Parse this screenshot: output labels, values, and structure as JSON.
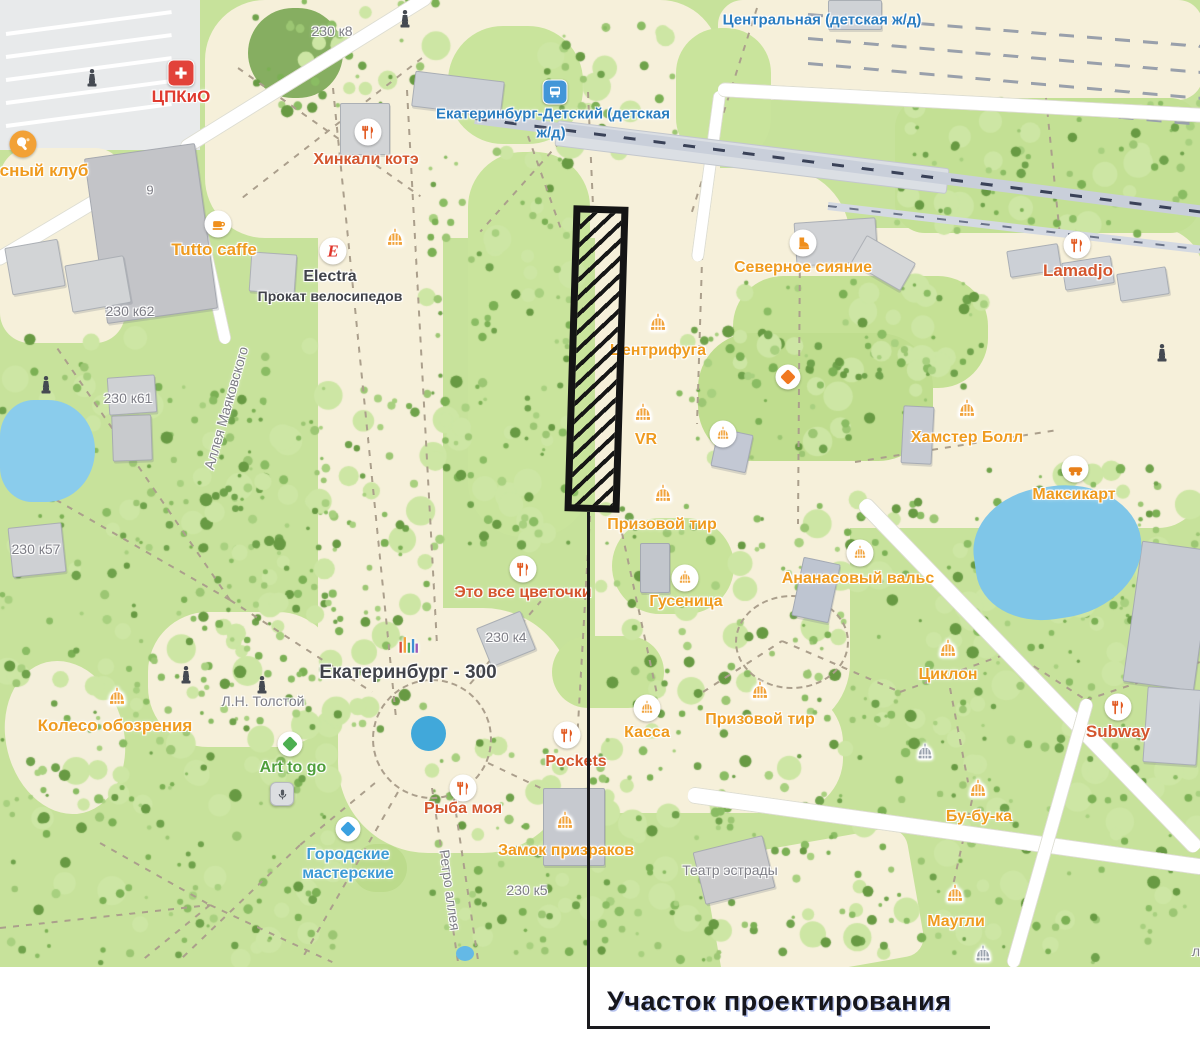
{
  "callout": {
    "label": "Участок проектирования"
  },
  "palette": {
    "poi_orange": "#ef9b1f",
    "poi_terracotta": "#d4562e",
    "transit_blue": "#2b7dc0",
    "poi_blue": "#3e9bd5",
    "poi_green": "#4f9f3c",
    "street_gray": "#7d7d85",
    "title_dark": "#41434a",
    "brand_red": "#e03a2f",
    "site_outline": "#141414",
    "water": "#7fc6e8"
  },
  "map": {
    "labels": [
      {
        "t": "ЦПКиО",
        "x": 181,
        "y": 97,
        "c": "red",
        "s": 17,
        "i": true
      },
      {
        "t": "сный клуб",
        "x": 44,
        "y": 171,
        "c": "orange",
        "s": 17,
        "i": true
      },
      {
        "t": "230 к8",
        "x": 332,
        "y": 31,
        "c": "gray",
        "s": 14,
        "w": "normal"
      },
      {
        "t": "Хинкали котэ",
        "x": 366,
        "y": 160,
        "c": "terra",
        "s": 16,
        "i": true
      },
      {
        "t": "Екатеринбург-Детский (детская",
        "x": 553,
        "y": 114,
        "c": "blue",
        "s": 15,
        "i": true
      },
      {
        "t": "ж/д)",
        "x": 551,
        "y": 133,
        "c": "blue",
        "s": 15,
        "i": true
      },
      {
        "t": "Центральная (детская ж/д)",
        "x": 822,
        "y": 20,
        "c": "blue",
        "s": 15,
        "i": true
      },
      {
        "t": "Tutto caffe",
        "x": 214,
        "y": 250,
        "c": "orange",
        "s": 17,
        "i": true
      },
      {
        "t": "Electra",
        "x": 330,
        "y": 277,
        "c": "dark",
        "s": 16,
        "i": true
      },
      {
        "t": "Прокат велосипедов",
        "x": 330,
        "y": 296,
        "c": "dark",
        "s": 14,
        "i": true
      },
      {
        "t": "230 к62",
        "x": 130,
        "y": 311,
        "c": "gray",
        "s": 14,
        "w": "normal"
      },
      {
        "t": "Аллея Маяковского",
        "x": 226,
        "y": 408,
        "c": "gray",
        "s": 14,
        "w": "normal",
        "r": -74
      },
      {
        "t": "230 к61",
        "x": 128,
        "y": 398,
        "c": "gray",
        "s": 14,
        "w": "normal"
      },
      {
        "t": "230 к57",
        "x": 36,
        "y": 549,
        "c": "gray",
        "s": 14,
        "w": "normal"
      },
      {
        "t": "Северное сияние",
        "x": 803,
        "y": 268,
        "c": "orange",
        "s": 16,
        "i": true
      },
      {
        "t": "Lamadjo",
        "x": 1078,
        "y": 271,
        "c": "terra",
        "s": 17,
        "i": true
      },
      {
        "t": "Центрифуга",
        "x": 658,
        "y": 351,
        "c": "orange",
        "s": 16,
        "i": true
      },
      {
        "t": "VR",
        "x": 646,
        "y": 440,
        "c": "orange",
        "s": 16,
        "i": true
      },
      {
        "t": "Хамстер Болл",
        "x": 967,
        "y": 438,
        "c": "orange",
        "s": 16,
        "i": true
      },
      {
        "t": "Максикарт",
        "x": 1074,
        "y": 495,
        "c": "orange",
        "s": 16,
        "i": true
      },
      {
        "t": "Призовой тир",
        "x": 662,
        "y": 525,
        "c": "orange",
        "s": 16,
        "i": true
      },
      {
        "t": "Ананасовый вальс",
        "x": 858,
        "y": 579,
        "c": "orange",
        "s": 16,
        "i": true
      },
      {
        "t": "Это все цветочки",
        "x": 523,
        "y": 593,
        "c": "terra",
        "s": 16,
        "i": true
      },
      {
        "t": "Гусеница",
        "x": 686,
        "y": 602,
        "c": "orange",
        "s": 16,
        "i": true
      },
      {
        "t": "230 к4",
        "x": 506,
        "y": 637,
        "c": "gray",
        "s": 14,
        "w": "normal"
      },
      {
        "t": "Екатеринбург - 300",
        "x": 408,
        "y": 673,
        "c": "dark",
        "s": 19,
        "i": true
      },
      {
        "t": "Л.Н. Толстой",
        "x": 263,
        "y": 701,
        "c": "gray",
        "s": 14,
        "w": "normal"
      },
      {
        "t": "Колесо обозрения",
        "x": 115,
        "y": 726,
        "c": "orange",
        "s": 17,
        "i": true
      },
      {
        "t": "Art to go",
        "x": 293,
        "y": 768,
        "c": "green",
        "s": 16,
        "i": true
      },
      {
        "t": "Касса",
        "x": 647,
        "y": 733,
        "c": "orange",
        "s": 16,
        "i": true
      },
      {
        "t": "Призовой тир",
        "x": 760,
        "y": 720,
        "c": "orange",
        "s": 16,
        "i": true
      },
      {
        "t": "Циклон",
        "x": 948,
        "y": 675,
        "c": "orange",
        "s": 16,
        "i": true
      },
      {
        "t": "Subway",
        "x": 1118,
        "y": 732,
        "c": "terra",
        "s": 17,
        "i": true
      },
      {
        "t": "Pockets",
        "x": 576,
        "y": 762,
        "c": "terra",
        "s": 16,
        "i": true
      },
      {
        "t": "Рыба моя",
        "x": 463,
        "y": 809,
        "c": "terra",
        "s": 16,
        "i": true
      },
      {
        "t": "Городские",
        "x": 348,
        "y": 855,
        "c": "bluepoi",
        "s": 16,
        "i": true
      },
      {
        "t": "мастерские",
        "x": 348,
        "y": 874,
        "c": "bluepoi",
        "s": 16,
        "i": true
      },
      {
        "t": "Замок призраков",
        "x": 566,
        "y": 851,
        "c": "orange",
        "s": 16,
        "i": true
      },
      {
        "t": "230 к5",
        "x": 527,
        "y": 890,
        "c": "gray",
        "s": 14,
        "w": "normal"
      },
      {
        "t": "Ретро аллея",
        "x": 450,
        "y": 890,
        "c": "gray",
        "s": 14,
        "w": "normal",
        "r": 82
      },
      {
        "t": "Театр эстрады",
        "x": 730,
        "y": 870,
        "c": "gray",
        "s": 14,
        "w": "normal"
      },
      {
        "t": "Бу-бу-ка",
        "x": 979,
        "y": 817,
        "c": "orange",
        "s": 16,
        "i": true
      },
      {
        "t": "Маугли",
        "x": 956,
        "y": 922,
        "c": "orange",
        "s": 16,
        "i": true
      },
      {
        "t": "9",
        "x": 150,
        "y": 190,
        "c": "gray",
        "s": 13,
        "w": "normal"
      },
      {
        "t": "л",
        "x": 1196,
        "y": 951,
        "c": "gray",
        "s": 14,
        "w": "normal"
      }
    ],
    "icons": [
      {
        "k": "cpkio",
        "x": 181,
        "y": 73
      },
      {
        "k": "pingpong",
        "x": 23,
        "y": 144
      },
      {
        "k": "fork",
        "x": 368,
        "y": 132
      },
      {
        "k": "transit",
        "x": 555,
        "y": 92
      },
      {
        "k": "statue",
        "x": 405,
        "y": 18
      },
      {
        "k": "statue",
        "x": 92,
        "y": 77
      },
      {
        "k": "coffee",
        "x": 218,
        "y": 224
      },
      {
        "k": "electra",
        "x": 333,
        "y": 251
      },
      {
        "k": "carousel",
        "x": 395,
        "y": 241
      },
      {
        "k": "statue",
        "x": 46,
        "y": 384
      },
      {
        "k": "carousel",
        "x": 658,
        "y": 326
      },
      {
        "k": "carousel",
        "x": 643,
        "y": 416
      },
      {
        "k": "carousel-circle",
        "x": 723,
        "y": 434
      },
      {
        "k": "diamond-orange",
        "x": 788,
        "y": 377
      },
      {
        "k": "boot",
        "x": 803,
        "y": 243
      },
      {
        "k": "fork",
        "x": 1077,
        "y": 245
      },
      {
        "k": "carousel",
        "x": 967,
        "y": 412
      },
      {
        "k": "kart",
        "x": 1075,
        "y": 469
      },
      {
        "k": "carousel",
        "x": 663,
        "y": 497
      },
      {
        "k": "fork",
        "x": 523,
        "y": 569
      },
      {
        "k": "carousel-circle",
        "x": 685,
        "y": 578
      },
      {
        "k": "carousel-circle",
        "x": 860,
        "y": 553
      },
      {
        "k": "carousel",
        "x": 948,
        "y": 652
      },
      {
        "k": "carousel",
        "x": 117,
        "y": 700
      },
      {
        "k": "statue",
        "x": 186,
        "y": 674
      },
      {
        "k": "statue",
        "x": 262,
        "y": 684
      },
      {
        "k": "columns",
        "x": 408,
        "y": 647
      },
      {
        "k": "diamond-green",
        "x": 290,
        "y": 744
      },
      {
        "k": "fork",
        "x": 567,
        "y": 735
      },
      {
        "k": "carousel-circle",
        "x": 647,
        "y": 708
      },
      {
        "k": "carousel",
        "x": 760,
        "y": 694
      },
      {
        "k": "carousel-gray",
        "x": 925,
        "y": 755
      },
      {
        "k": "fork",
        "x": 463,
        "y": 788
      },
      {
        "k": "diamond-blue",
        "x": 348,
        "y": 829
      },
      {
        "k": "carousel",
        "x": 565,
        "y": 824
      },
      {
        "k": "mic",
        "x": 282,
        "y": 794
      },
      {
        "k": "fork",
        "x": 1118,
        "y": 707
      },
      {
        "k": "carousel",
        "x": 978,
        "y": 792
      },
      {
        "k": "carousel",
        "x": 955,
        "y": 897
      },
      {
        "k": "carousel-gray",
        "x": 983,
        "y": 957
      },
      {
        "k": "statue",
        "x": 1162,
        "y": 352
      }
    ]
  }
}
